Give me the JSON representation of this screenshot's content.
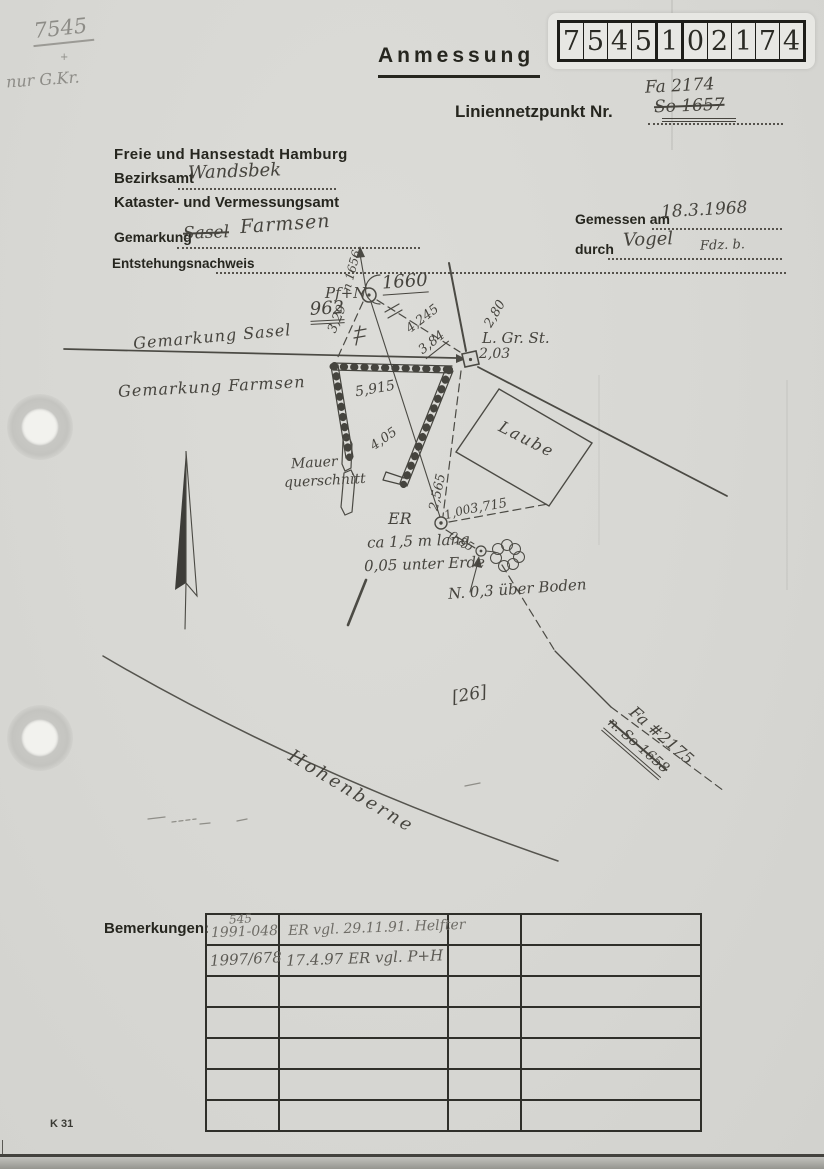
{
  "colors": {
    "ink": "#26261f",
    "hand_ink": "#46443e",
    "pencil": "#8d8c87",
    "paper": "#d7d7d3"
  },
  "corner": {
    "number": "7545",
    "plus": "+",
    "note": "nur G.Kr."
  },
  "title": "Anmessung",
  "code_digits": [
    "7",
    "5",
    "4",
    "5",
    "1",
    "0",
    "2",
    "1",
    "7",
    "4"
  ],
  "ref": {
    "fa": "Fa 2174",
    "line_label": "Liniennetzpunkt Nr.",
    "old_number": "So 1657"
  },
  "agency": {
    "city": "Freie und Hansestadt Hamburg",
    "district_label": "Bezirksamt",
    "district": "Wandsbek",
    "office": "Kataster- und Vermessungsamt",
    "gemarkung_label": "Gemarkung",
    "gemarkung_old": "Sasel",
    "gemarkung": "Farmsen",
    "origin_label": "Entstehungsnachweis"
  },
  "measure": {
    "date_label": "Gemessen am",
    "date": "18.3.1968",
    "by_label": "durch",
    "by": "Vogel",
    "by2": "Fdz. b."
  },
  "sketch": {
    "n_ref": "n 1656",
    "pf_n": "Pf+N",
    "pt1660": "1660",
    "pt962": "962",
    "d329": "3,29",
    "d4245": "4,245",
    "d384": "3,84",
    "d280": "2,80",
    "lgrst": "L. Gr. St.",
    "d203": "2,03",
    "gem_sasel": "Gemarkung  Sasel",
    "gem_farmsen": "Gemarkung Farmsen",
    "d5915": "5,915",
    "d405": "4,05",
    "laube": "Laube",
    "mauer1": "Mauer",
    "mauer2": "querschnitt",
    "d2565": "2,565",
    "er": "ER",
    "er_l2": "ca 1,5 m lang",
    "er_l3": "0,05 unter Erde",
    "d100": "1,00",
    "d3715": "3,715",
    "d085": "0,85",
    "n_boden": "N. 0,3 über Boden",
    "flur": "[26]",
    "fa2175": "Fa #2175",
    "so1658": "n. So 1658",
    "hohenberne": "Hohenberne"
  },
  "bemerkungen": {
    "label": "Bemerkungen:",
    "r1a": "545",
    "r1b": "1991-048",
    "r1c": "ER vgl. 29.11.91. Helfter",
    "r2b": "1997/678",
    "r2c": "17.4.97 ER vgl. P+H"
  },
  "footer": {
    "code": "K 31"
  }
}
